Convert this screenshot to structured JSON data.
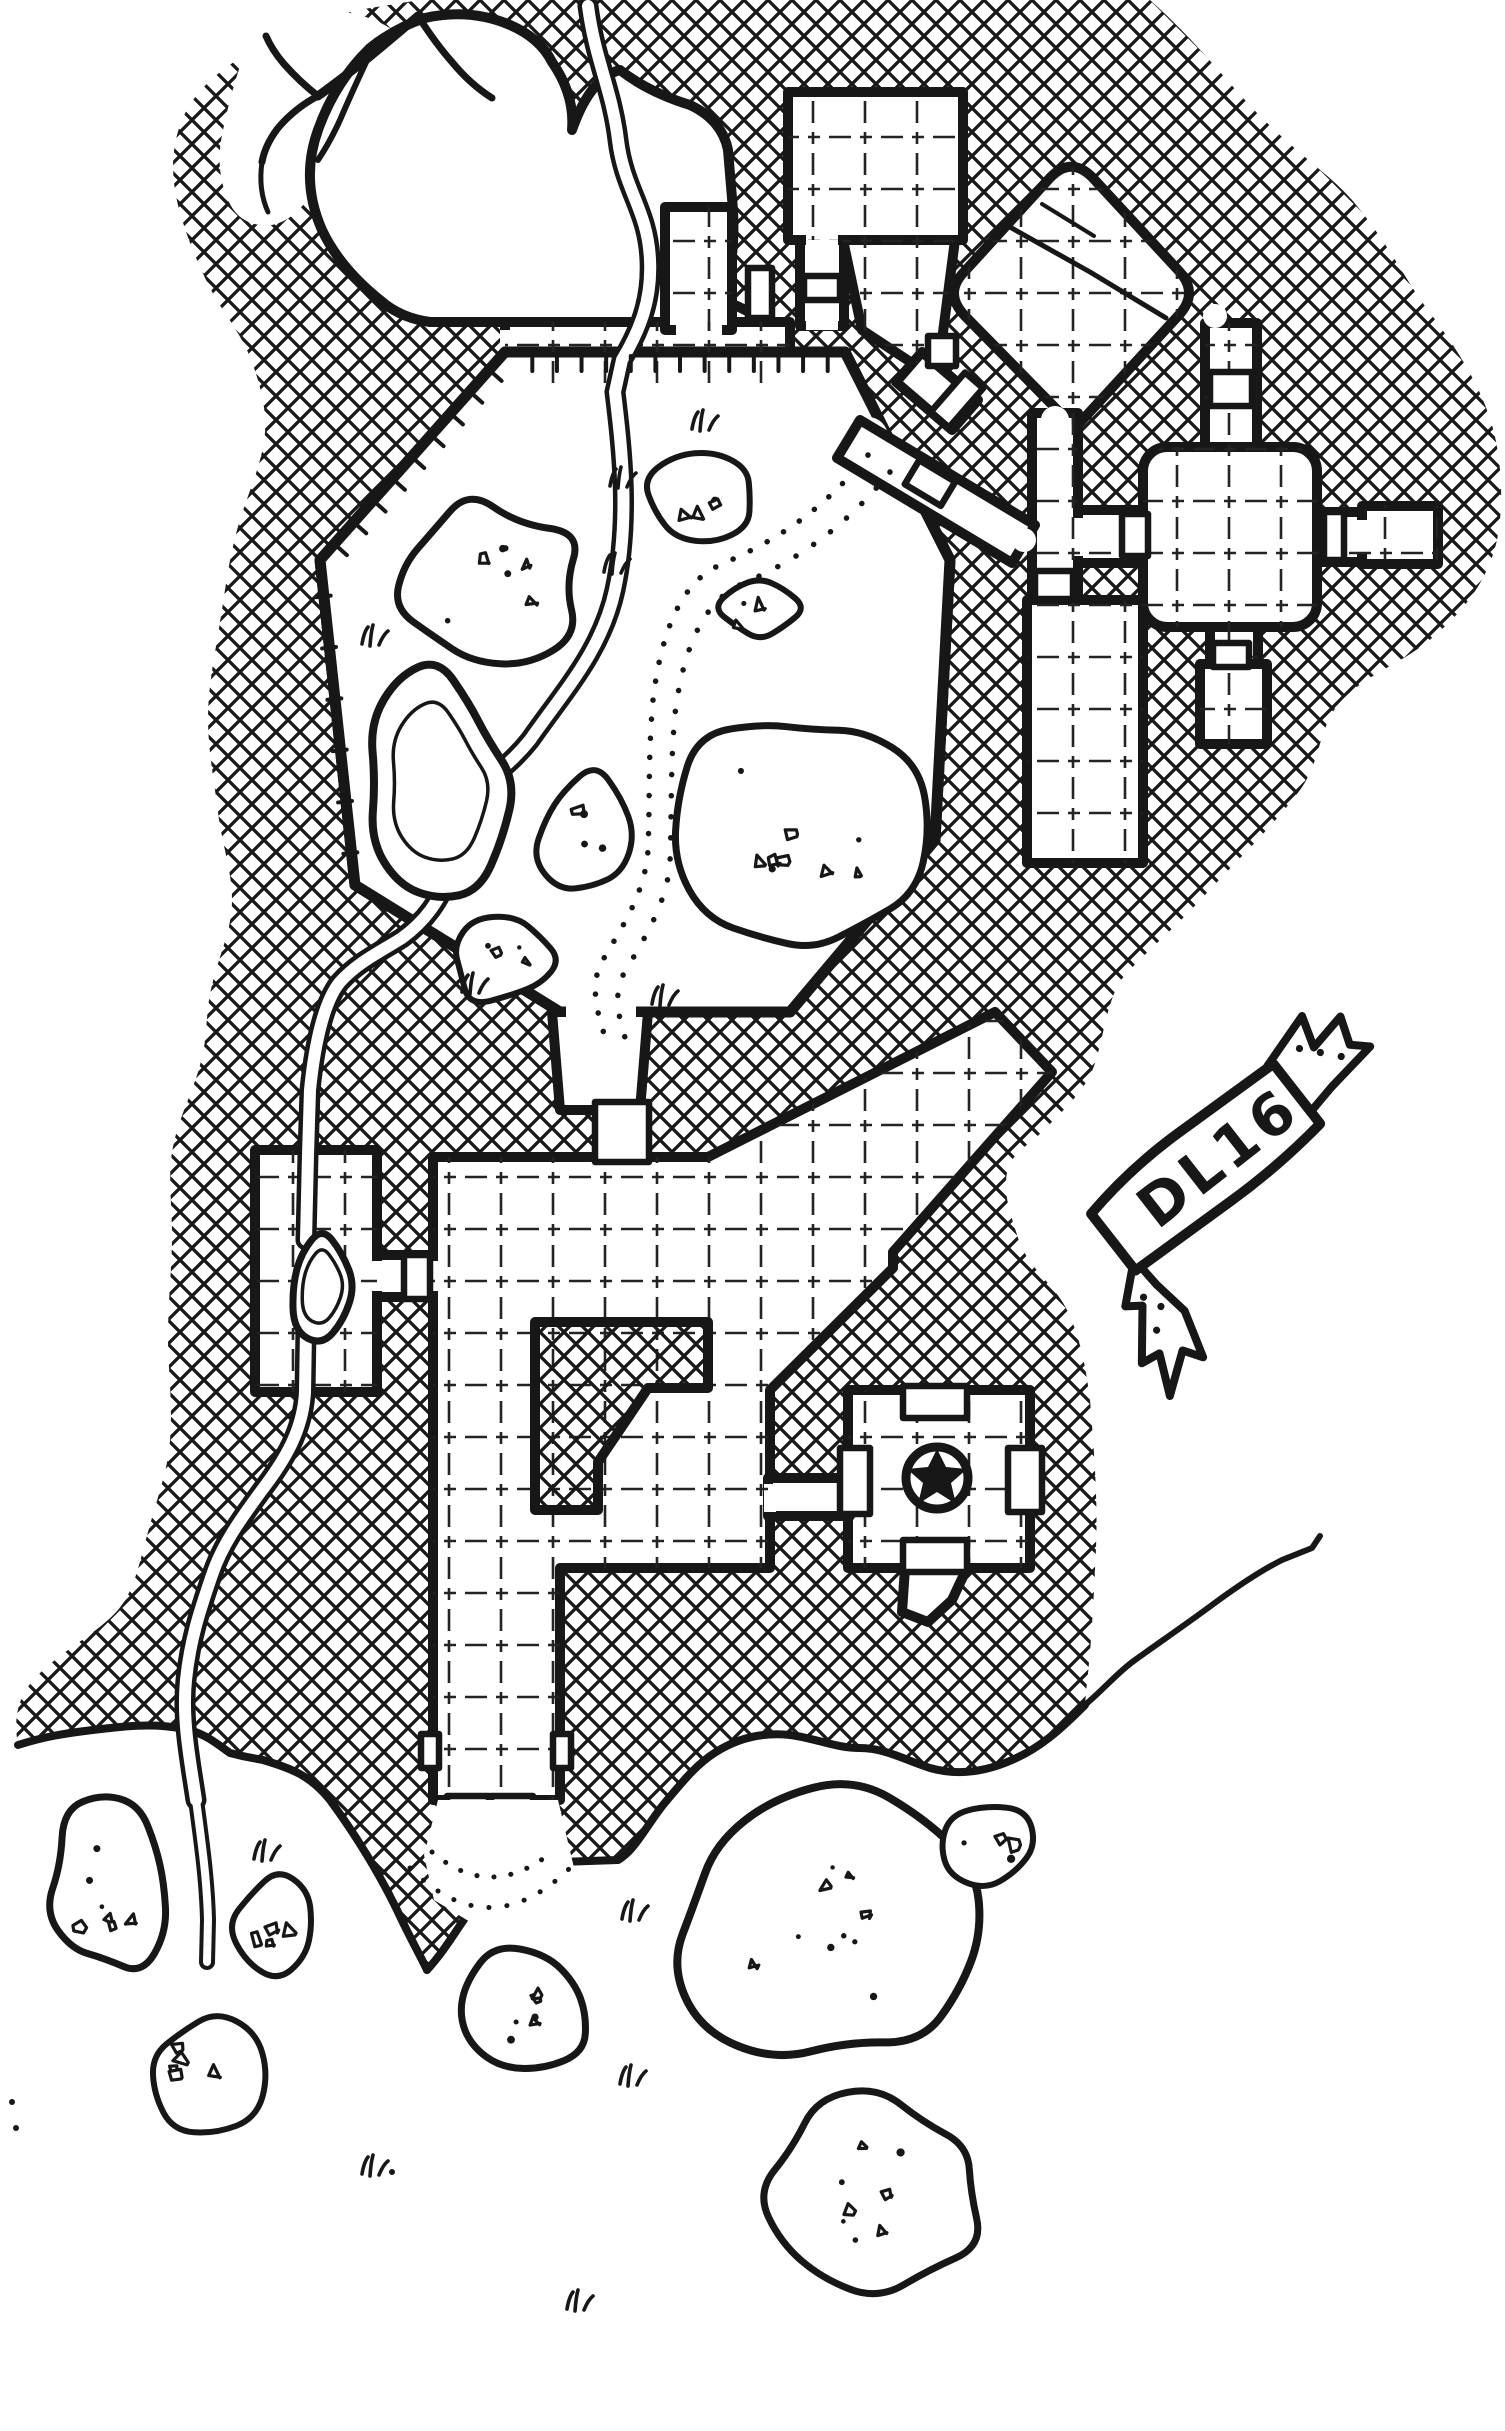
{
  "canvas": {
    "width": 1505,
    "height": 2431,
    "paper_color": "#ffffff",
    "ink_color": "#171717"
  },
  "banner": {
    "label": "DL16"
  },
  "symbols": [
    {
      "name": "star-marker",
      "glyph": "★"
    }
  ],
  "features": [
    "cross-hatched-rock-mass",
    "octagonal-cavern",
    "cavern-pond",
    "underground-stream",
    "dotted-trail",
    "boulder-clusters",
    "grass-tufts",
    "gridded-rooms",
    "diamond-room",
    "cross-shaped-room",
    "great-hall-with-pillar",
    "bridge-room-over-stream",
    "star-marker-room",
    "double-door-south-exit",
    "cliff-edge",
    "title-banner"
  ]
}
